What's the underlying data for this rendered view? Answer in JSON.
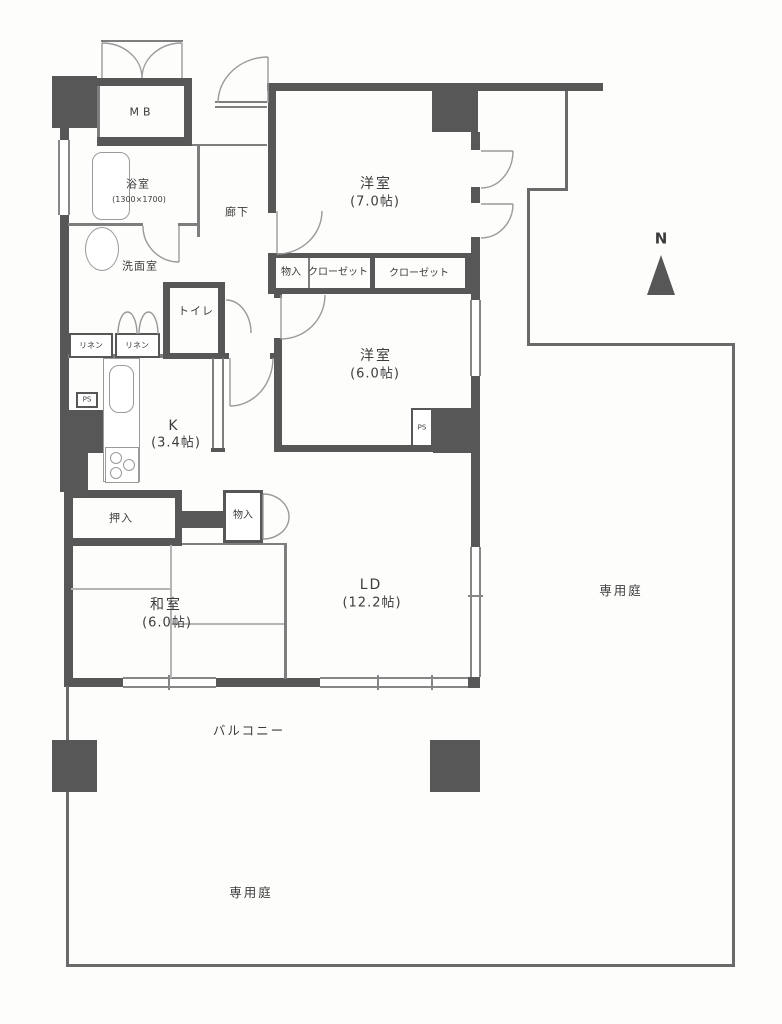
{
  "plan": {
    "labels": {
      "mb": "MB",
      "bath": "浴室",
      "bath_size": "(1300×1700)",
      "wash": "洗面室",
      "toilet": "トイレ",
      "linen1": "リネン",
      "linen2": "リネン",
      "hall": "廊下",
      "storage1": "物入",
      "closet1": "クローゼット",
      "closet2": "クローゼット",
      "west1": "洋室",
      "west1_size": "(7.0帖)",
      "west2": "洋室",
      "west2_size": "(6.0帖)",
      "ps1": "PS",
      "ps2": "PS",
      "kitchen": "K",
      "kitchen_size": "(3.4帖)",
      "oshiire": "押入",
      "storage2": "物入",
      "japanese_room": "和室",
      "japanese_room_size": "(6.0帖)",
      "living_dining": "LD",
      "living_dining_size": "(12.2帖)",
      "balcony": "バルコニー",
      "garden_right": "専用庭",
      "garden_bottom": "専用庭",
      "north": "N"
    },
    "colors": {
      "wall": "#575757",
      "thin_line": "#7e7e7e",
      "garden_line": "#6a6a6a",
      "fixture_line": "#9a9a9a",
      "text": "#3c3c3c",
      "background": "#fdfdfc"
    }
  }
}
